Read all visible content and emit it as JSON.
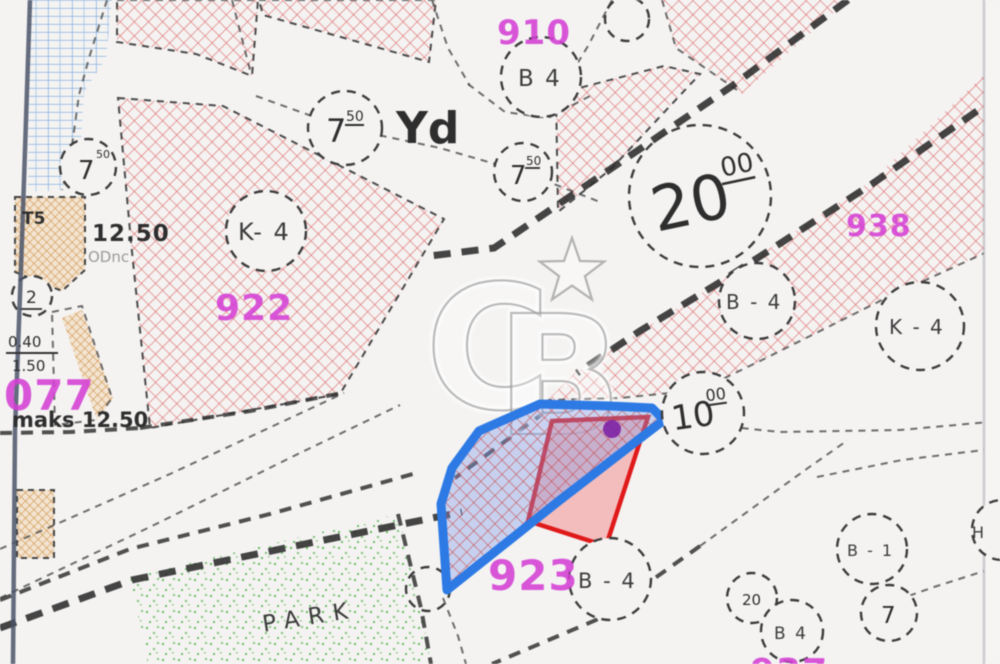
{
  "meta": {
    "description": "Zoning plan (imar plani) map screenshot with highlighted parcel and CB watermark"
  },
  "watermark": {
    "letters": "CB",
    "star": "★",
    "tm": "™"
  },
  "parcels": {
    "p910": {
      "number": "910",
      "zone": "B 4"
    },
    "p922": {
      "number": "922",
      "zone": "K- 4"
    },
    "p938": {
      "number": "938"
    },
    "p923": {
      "number": "923",
      "zone": "B - 4"
    },
    "p077": {
      "number": "077"
    },
    "p_bottom": {
      "number": "937"
    }
  },
  "zones": {
    "b4_right": "B - 4",
    "k4_right": "K - 4",
    "b1": "B - 1",
    "b4_small": "B 4",
    "h": "H",
    "v20": "20"
  },
  "roads": {
    "w20": {
      "value": "20",
      "sup": "00"
    },
    "w10": {
      "value": "10",
      "sup": "00"
    },
    "label_yd": "Yd"
  },
  "circles7": {
    "a": {
      "value": "7",
      "sup": "50"
    },
    "b": {
      "value": "7",
      "sup": "50"
    },
    "left": {
      "value": "7",
      "sup": "50"
    },
    "br": {
      "value": "7"
    },
    "c2": "2"
  },
  "annotations": {
    "t5": "T5",
    "dim": "12.50",
    "dim_sub": "ODnc",
    "fraction_top": "0.40",
    "fraction_bottom": "1.50",
    "maks": "maks 12.50",
    "park": "PARK"
  },
  "colors": {
    "magenta": "#d43fd4",
    "red_hatch": "#dd5c5c",
    "blue_hatch": "#6aa0dc",
    "orange_hatch": "#cf8f45",
    "park_green": "#4db04a",
    "highlight_blue": "#2d7ae5",
    "highlight_red": "#e01a1a",
    "purple_dot": "#7d22a5",
    "road_black": "#2b2b2b"
  }
}
